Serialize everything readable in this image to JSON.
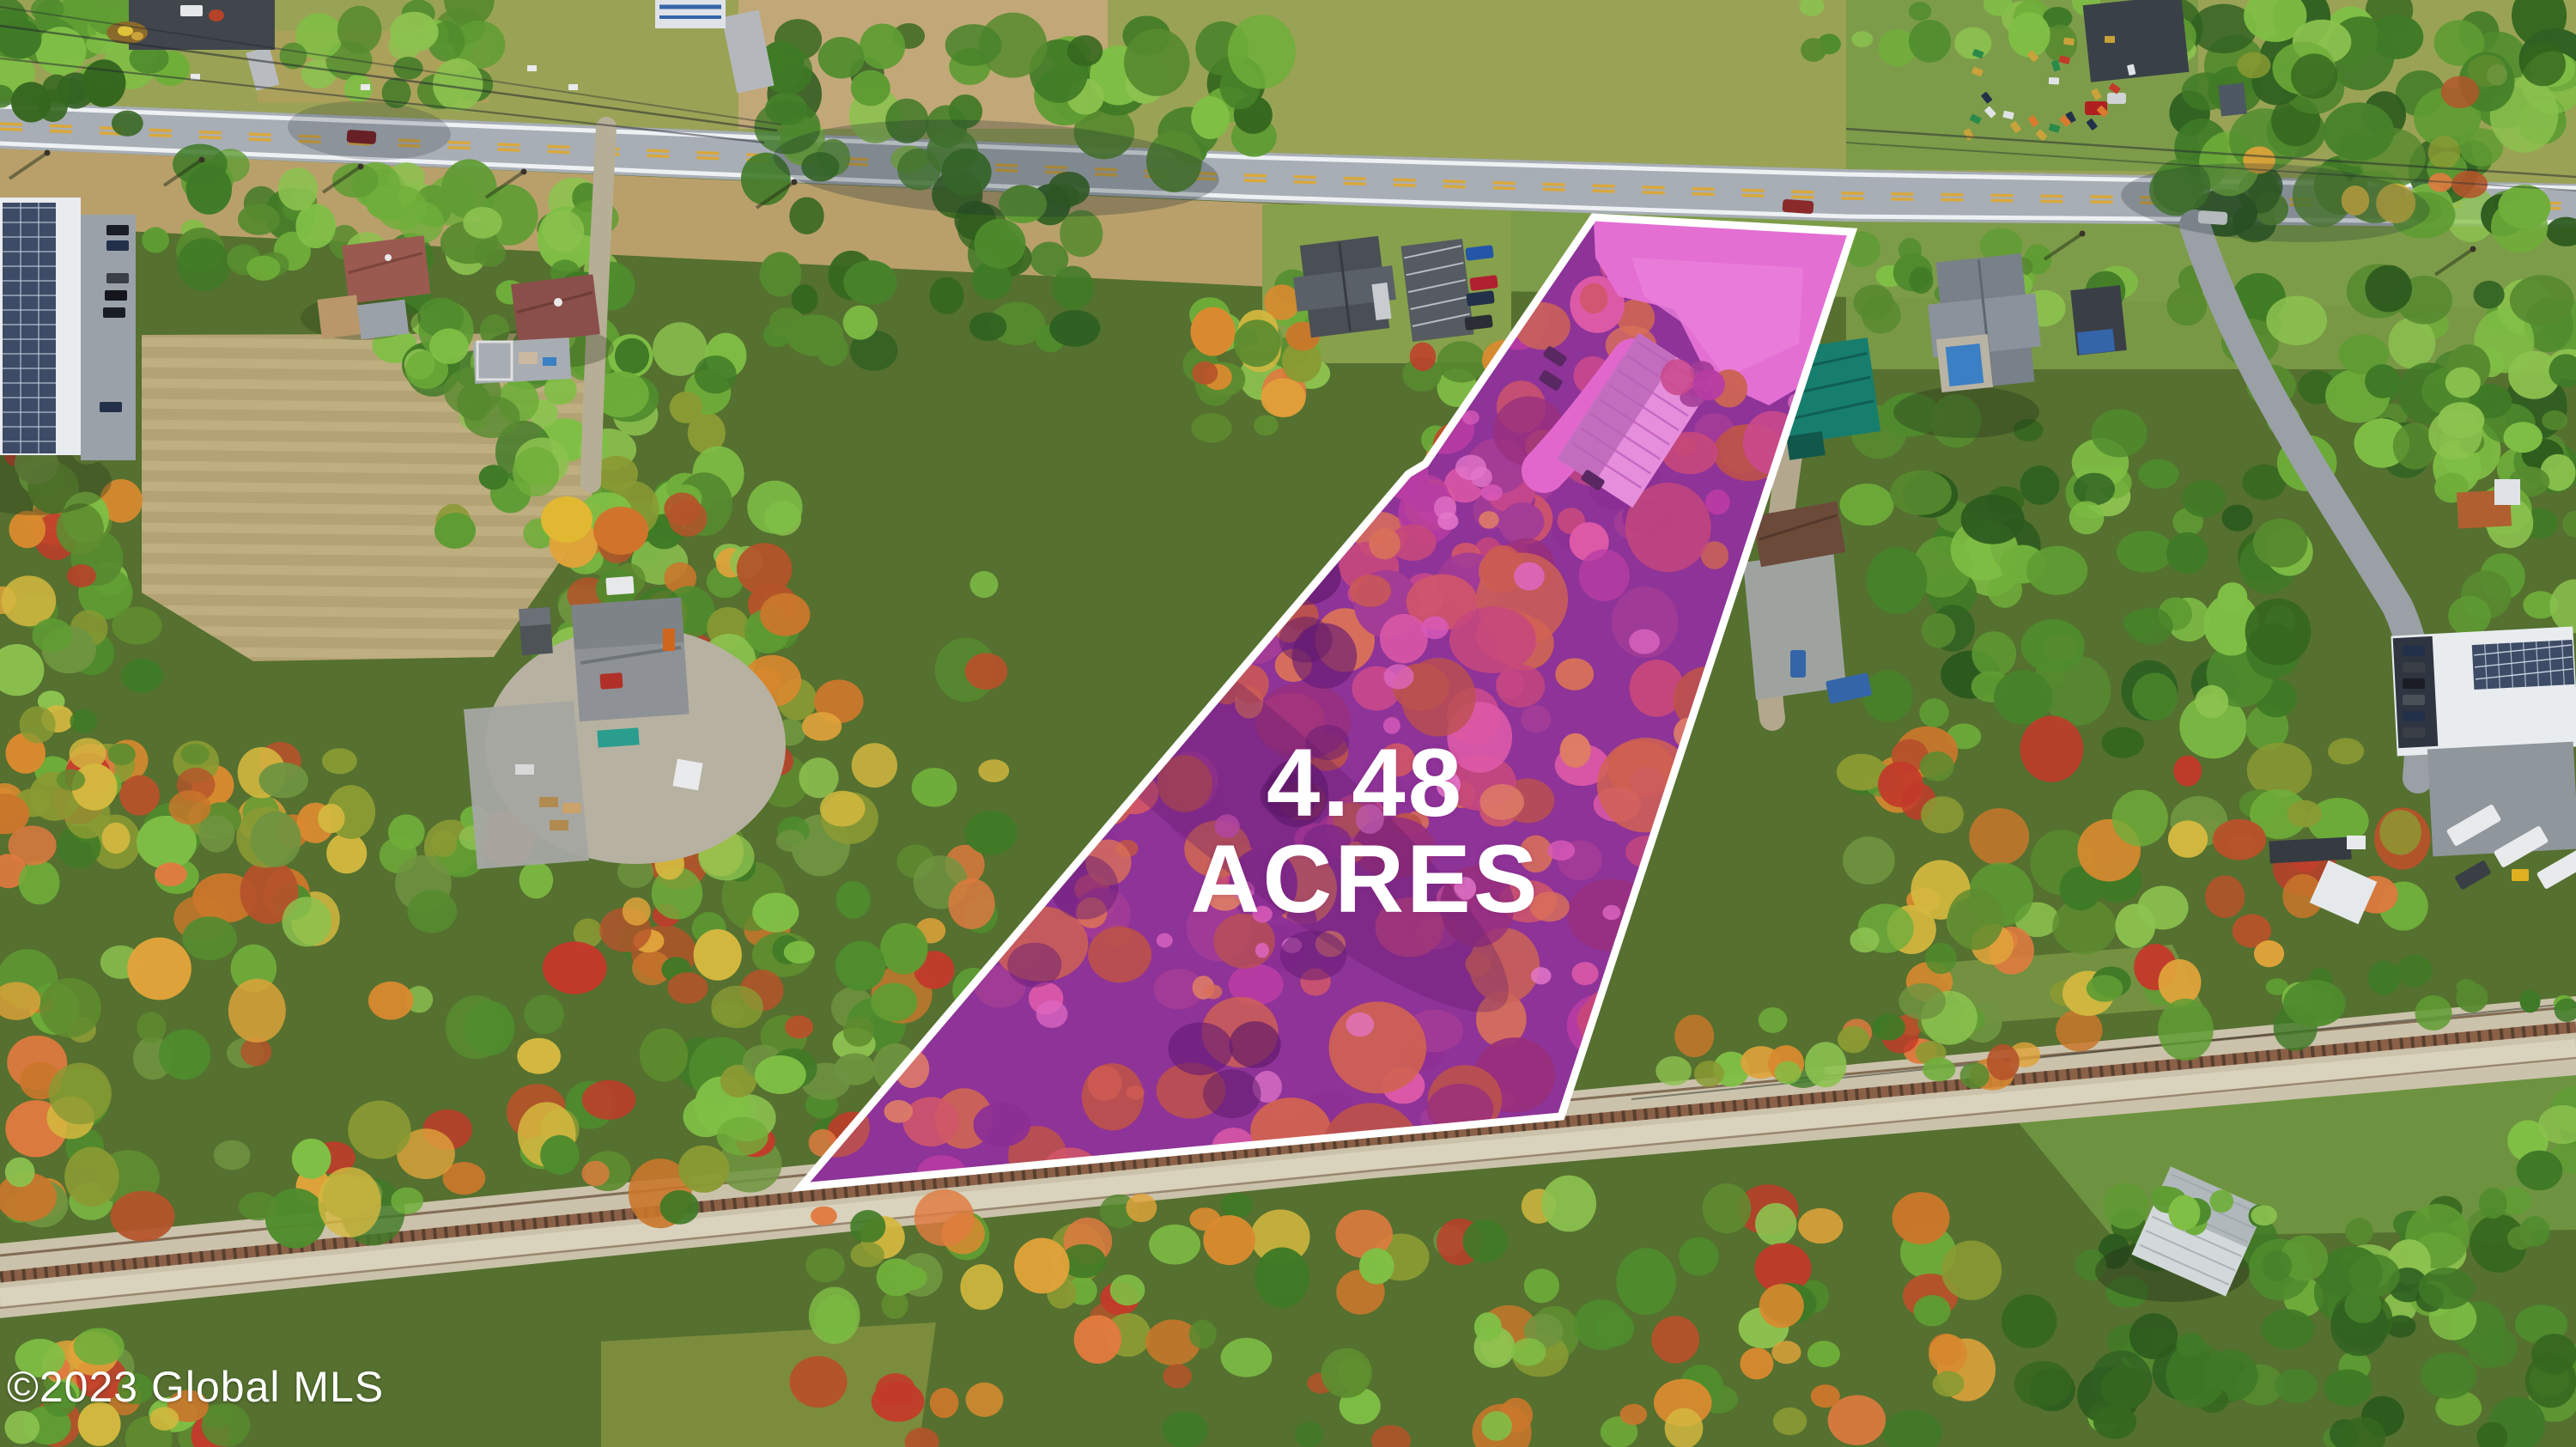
{
  "photo": {
    "caption": "Aerial drone view of a wooded roadside parcel in autumn with a highlighted lot for sale"
  },
  "parcel": {
    "area_value": "4.48",
    "area_unit": "ACRES",
    "label_color": "#ffffff",
    "highlight_color": "#d944c8",
    "boundary_color": "#ffffff"
  },
  "watermark": {
    "text": "©2023 Global MLS",
    "color": "#ffffff"
  }
}
